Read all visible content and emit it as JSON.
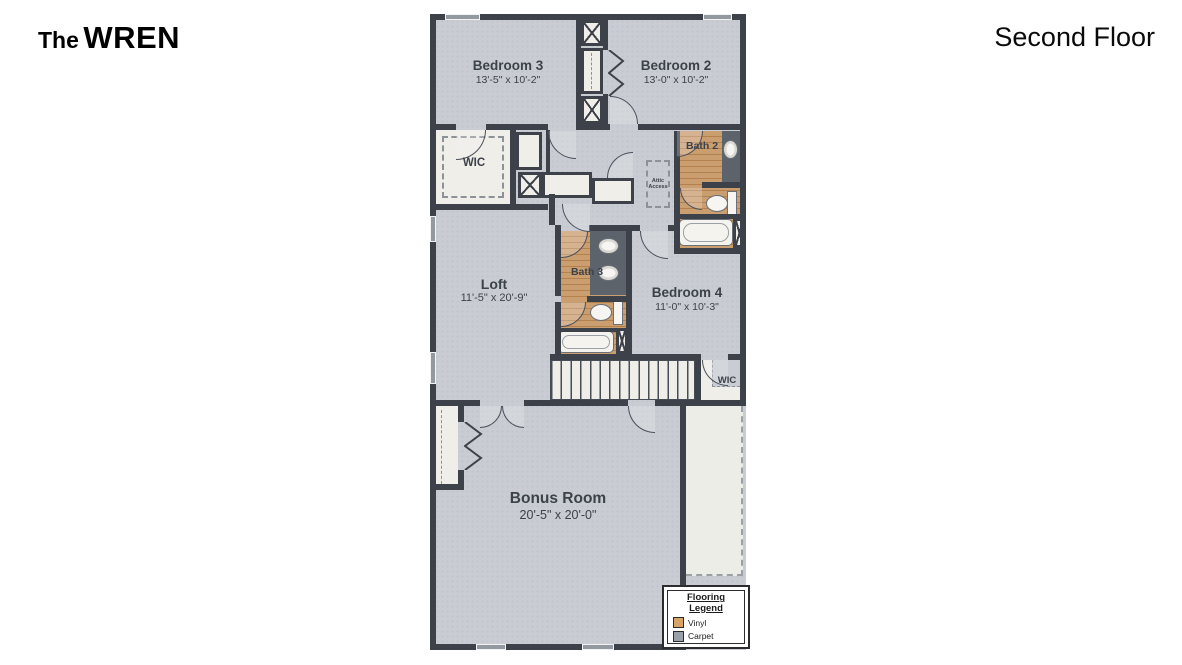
{
  "header": {
    "plan_prefix": "The",
    "plan_name": "WREN",
    "floor": "Second Floor"
  },
  "rooms": {
    "bedroom3": {
      "label": "Bedroom 3",
      "dims": "13'-5\" x 10'-2\""
    },
    "bedroom2": {
      "label": "Bedroom 2",
      "dims": "13'-0\" x 10'-2\""
    },
    "bedroom4": {
      "label": "Bedroom 4",
      "dims": "11'-0\" x 10'-3\""
    },
    "loft": {
      "label": "Loft",
      "dims": "11'-5\" x 20'-9\""
    },
    "bonus": {
      "label": "Bonus Room",
      "dims": "20'-5\" x 20'-0\""
    },
    "bath2": {
      "label": "Bath 2"
    },
    "bath3": {
      "label": "Bath 3"
    },
    "wic_left": {
      "label": "WIC"
    },
    "wic_right": {
      "label": "WIC"
    },
    "attic": {
      "line1": "Attic",
      "line2": "Access"
    }
  },
  "legend": {
    "title1": "Flooring",
    "title2": "Legend",
    "items": [
      {
        "label": "Vinyl",
        "swatch": "#d9a368"
      },
      {
        "label": "Carpet",
        "swatch": "#9ba1a8"
      }
    ]
  },
  "colors": {
    "wall": "#3d424a",
    "carpet": "#c9cdd3",
    "vinyl": "#c89a6a",
    "closet": "#efeee9",
    "counter": "#5d636b",
    "unfinished": "#ecede7"
  }
}
